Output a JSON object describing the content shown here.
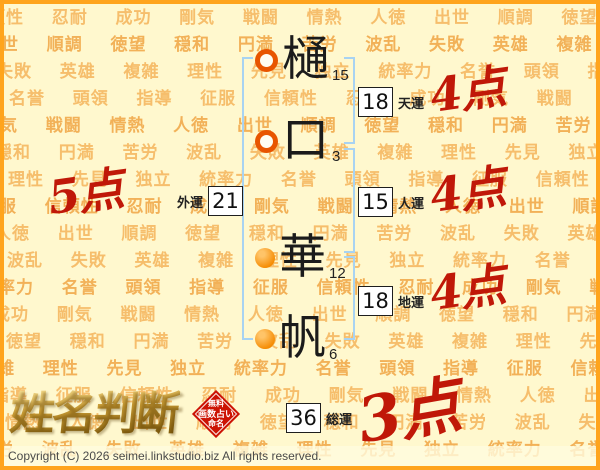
{
  "page": {
    "copyright": "Copyright (C) 2026 seimei.linkstudio.biz All rights reserved.",
    "background_words": [
      "信頼性",
      "忍耐",
      "成功",
      "剛気",
      "戦闘",
      "情熱",
      "人徳",
      "出世",
      "順調",
      "徳望",
      "穏和",
      "円満",
      "苦労",
      "波乱",
      "失敗",
      "英雄",
      "複雑",
      "理性",
      "先見",
      "独立",
      "統率力",
      "名誉",
      "頭領",
      "指導",
      "征服"
    ]
  },
  "name_chart": {
    "characters": [
      {
        "char": "樋",
        "strokes": "15",
        "part": "surname"
      },
      {
        "char": "口",
        "strokes": "3",
        "part": "surname"
      },
      {
        "char": "華",
        "strokes": "12",
        "part": "given"
      },
      {
        "char": "帆",
        "strokes": "6",
        "part": "given"
      }
    ],
    "fortunes": {
      "tenun": {
        "label": "天運",
        "value": "18",
        "score": "4点"
      },
      "jinun": {
        "label": "人運",
        "value": "15",
        "score": "4点"
      },
      "chiun": {
        "label": "地運",
        "value": "18",
        "score": "4点"
      },
      "gaiun": {
        "label": "外運",
        "value": "21",
        "score": "5点"
      },
      "soun": {
        "label": "総運",
        "value": "36",
        "score": "3点"
      }
    }
  },
  "logo": {
    "title": "姓名判断",
    "seal_lines": [
      "無料",
      "画数占い",
      "命名"
    ]
  },
  "colors": {
    "background": "#FFF8CE",
    "frame_orange": "#FFA41C",
    "watermark_text": "#F6BE6C",
    "bracket_blue": "#A8D3F2",
    "marker_orange": "#F58A00",
    "score_red": "#C01808",
    "seal_red": "#CC1303"
  }
}
